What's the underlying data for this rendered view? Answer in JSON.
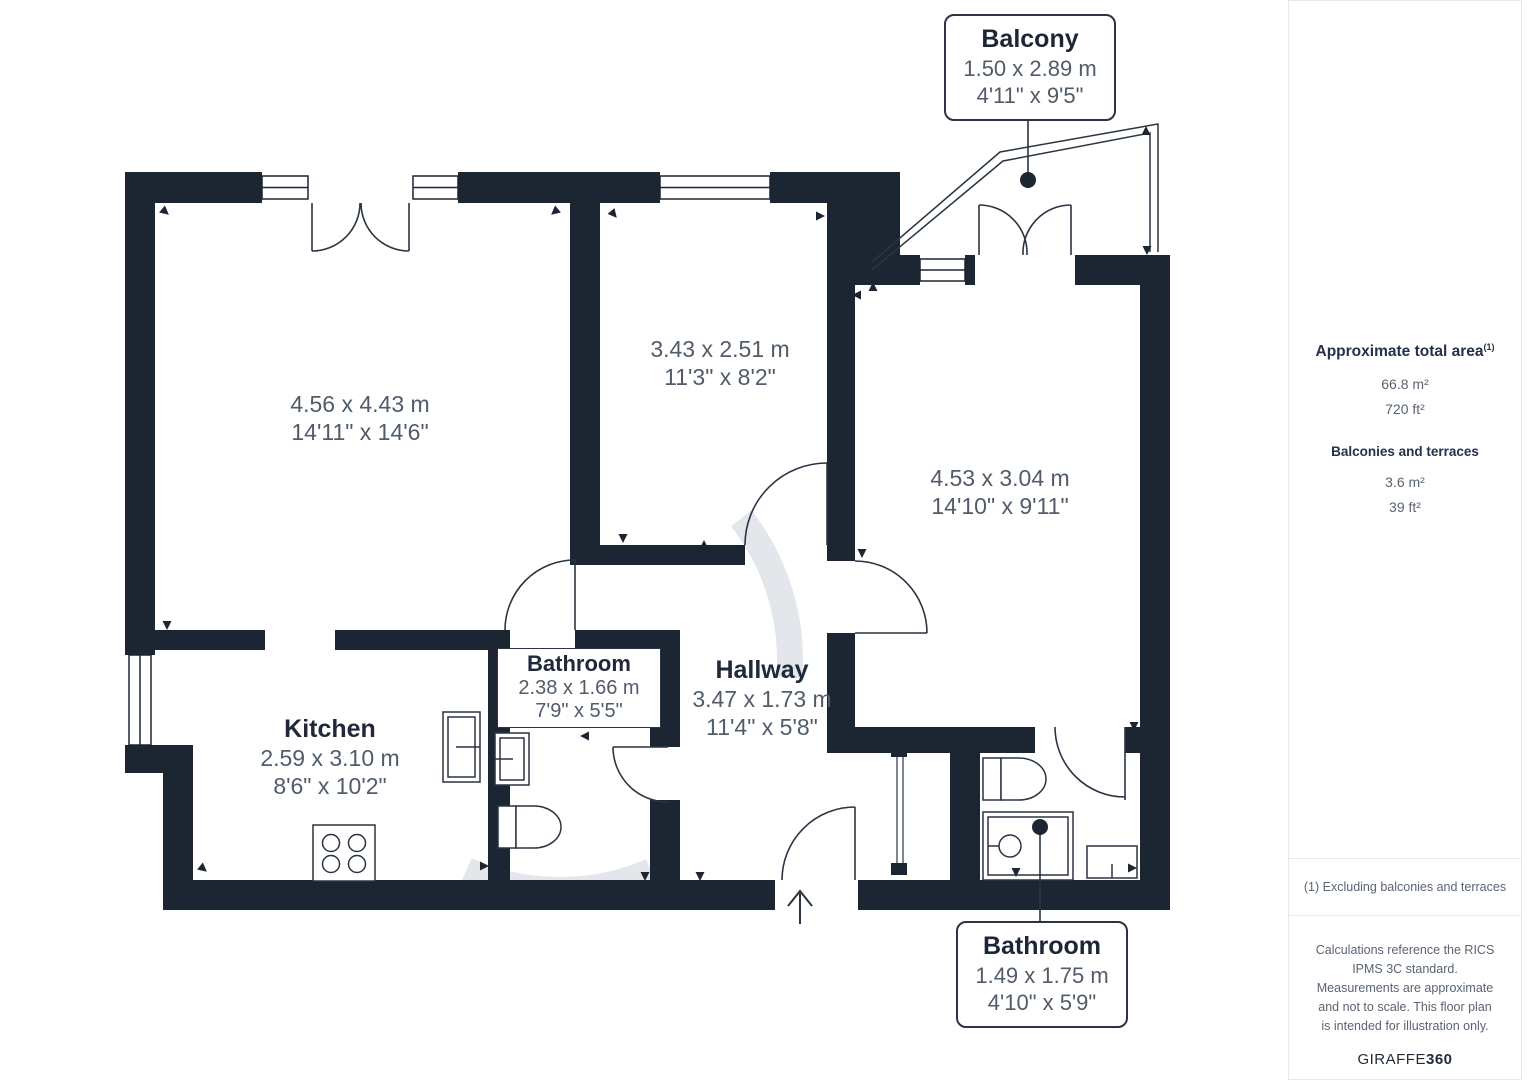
{
  "plan": {
    "rooms": [
      {
        "name": "",
        "metric": "4.56 x 4.43 m",
        "imperial": "14'11\" x 14'6\""
      },
      {
        "name": "",
        "metric": "3.43 x 2.51 m",
        "imperial": "11'3\" x 8'2\""
      },
      {
        "name": "",
        "metric": "4.53 x 3.04 m",
        "imperial": "14'10\" x 9'11\""
      },
      {
        "name": "Kitchen",
        "metric": "2.59 x 3.10 m",
        "imperial": "8'6\" x 10'2\""
      },
      {
        "name": "Bathroom",
        "metric": "2.38 x 1.66 m",
        "imperial": "7'9\" x 5'5\""
      },
      {
        "name": "Hallway",
        "metric": "3.47 x 1.73 m",
        "imperial": "11'4\" x 5'8\""
      }
    ],
    "callouts": [
      {
        "name": "Balcony",
        "metric": "1.50 x 2.89 m",
        "imperial": "4'11\" x 9'5\""
      },
      {
        "name": "Bathroom",
        "metric": "1.49 x 1.75 m",
        "imperial": "4'10\" x 5'9\""
      }
    ]
  },
  "sidebar": {
    "total_area_label": "Approximate total area",
    "total_area_superscript": "(1)",
    "total_area_m2": "66.8 m²",
    "total_area_ft2": "720 ft²",
    "balconies_label": "Balconies and terraces",
    "balconies_m2": "3.6 m²",
    "balconies_ft2": "39 ft²",
    "footnote": "(1) Excluding balconies and terraces",
    "disclaimer": "Calculations reference the RICS IPMS 3C standard. Measurements are approximate and not to scale. This floor plan is intended for illustration only.",
    "brand_prefix": "GIRAFFE",
    "brand_suffix": "360"
  },
  "colors": {
    "wall": "#1c2532",
    "room_name": "#20293a",
    "dimension": "#515c6b",
    "watermark": "#ccd1d8"
  }
}
